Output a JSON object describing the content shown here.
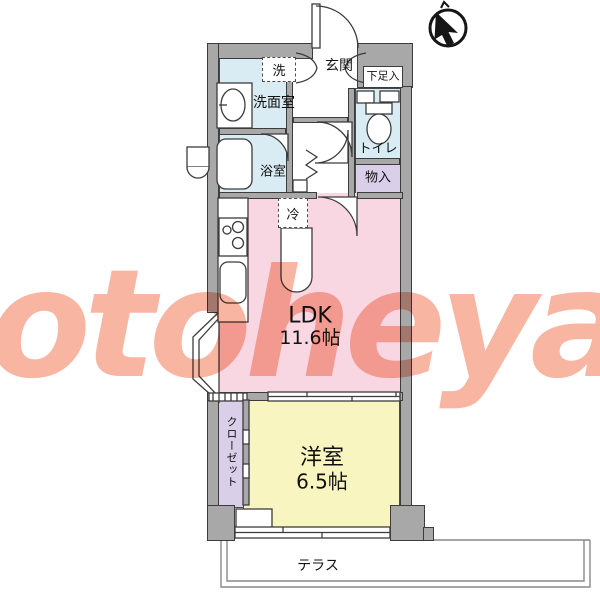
{
  "watermark": {
    "text": "otoheya"
  },
  "north_indicator": {
    "icon": "north-arrow-icon"
  },
  "floorplan": {
    "rooms": {
      "entrance": {
        "label": "玄関"
      },
      "shoe_cabinet": {
        "label": "下足入"
      },
      "washroom": {
        "label": "洗面室"
      },
      "bathroom": {
        "label": "浴室"
      },
      "toilet": {
        "label": "トイレ"
      },
      "storage": {
        "label": "物入"
      },
      "ldk": {
        "label": "LDK",
        "size": "11.6帖"
      },
      "closet": {
        "label": "クローゼット"
      },
      "western_room": {
        "label": "洋室",
        "size": "6.5帖"
      },
      "terrace": {
        "label": "テラス"
      }
    },
    "fixtures": {
      "washer": {
        "label": "洗"
      },
      "refrigerator": {
        "label": "冷"
      }
    },
    "colors": {
      "wall_gray": "#a8a8a8",
      "outline": "#3c3c3c",
      "wet_area_blue": "#d9ebf3",
      "ldk_pink": "#f9d7e2",
      "room_yellow": "#f8f5c0",
      "storage_lavender": "#d9cfe8",
      "watermark_salmon": "#f7a28b"
    }
  }
}
